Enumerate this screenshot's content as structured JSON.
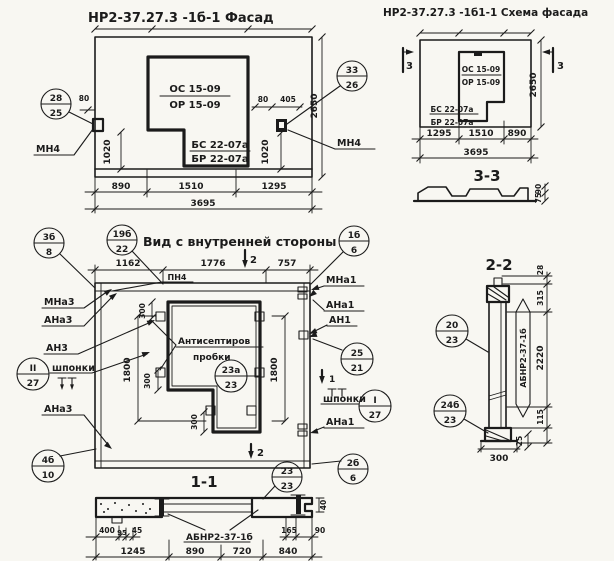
{
  "sheet": {
    "bg": "#f8f7f2",
    "ink": "#1b1b1b"
  },
  "facade": {
    "title": "НР2-37.27.3 -1б-1 Фасад",
    "window_mark_top": "ОС 15-09",
    "window_mark_bottom": "ОР 15-09",
    "sill_mark_top": "БС 22-07а",
    "sill_mark_bottom": "БР 22-07а",
    "anchor_left": "МН4",
    "anchor_right": "МН4",
    "callout_left_top": "28",
    "callout_left_bottom": "25",
    "callout_right_top": "33",
    "callout_right_bottom": "26",
    "dim_offset_left": "80",
    "dim_left_height": "1020",
    "dim_offset_right": "80",
    "dim_offset_right2": "405",
    "dim_right_height": "1020",
    "dim_height_total": "2650",
    "dim_w1": "890",
    "dim_w2": "1510",
    "dim_w3": "1295",
    "dim_w_total": "3695"
  },
  "schema": {
    "title": "НР2-37.27.3 -1б1-1 Схема фасада",
    "window_mark_top": "ОС 15-09",
    "window_mark_bottom": "ОР 15-09",
    "sill_mark_top": "БС 22-07а",
    "sill_mark_bottom": "БР 22-07а",
    "cut_left": "3",
    "cut_right": "3",
    "dim_height_total": "2650",
    "dim_w1": "1295",
    "dim_w2": "1510",
    "dim_w3": "890",
    "dim_w_total": "3695",
    "section_title": "3-3",
    "profile_dim_top": "90",
    "profile_dim_bottom": "75"
  },
  "interior": {
    "title": "Вид с внутренней стороны",
    "callout_title_top": "19б",
    "callout_title_bottom": "22",
    "callout_tl_top": "3б",
    "callout_tl_bottom": "8",
    "callout_tr_top": "1б",
    "callout_tr_bottom": "6",
    "dim_w1": "1162",
    "dim_w2": "1776",
    "dim_w3": "757",
    "cut_top": "2",
    "cut_bottom": "2",
    "cut_right": "1",
    "strip_label": "ПН4",
    "label_mna3": "МНа3",
    "label_ana3": "АНа3",
    "label_an3": "АН3",
    "label_keys_left": "шпонки",
    "label_ana3_low": "АНа3",
    "callout_keys_left_top": "II",
    "callout_keys_left_bottom": "27",
    "callout_bl_top": "4б",
    "callout_bl_bottom": "10",
    "label_mna1": "МНа1",
    "label_ana1": "АНа1",
    "label_an1": "АН1",
    "label_keys_right": "шпонки",
    "label_ana1_low": "АНа1",
    "callout_mid_right_top": "25",
    "callout_mid_right_bottom": "21",
    "callout_keys_right_top": "I",
    "callout_keys_right_bottom": "27",
    "callout_br_top": "2б",
    "callout_br_bottom": "6",
    "note_line1": "Антисептиров",
    "note_line2": "пробки",
    "callout_plugs_top": "23а",
    "callout_plugs_bottom": "23",
    "dim_300_a": "300",
    "dim_300_b": "300",
    "dim_300_c": "300",
    "dim_1800_left": "1800",
    "dim_1800_right": "1800"
  },
  "section11": {
    "title": "1-1",
    "callout_top": "23",
    "callout_bottom": "23",
    "label": "АБНР2-37-1б",
    "d400": "400",
    "d95": "95",
    "d45": "45",
    "d165": "165",
    "d90": "90",
    "d40": "40",
    "d1245": "1245",
    "d890": "890",
    "d720": "720",
    "d840": "840"
  },
  "section22": {
    "title": "2-2",
    "label": "АБНР2-37-1б",
    "callout_a_top": "20",
    "callout_a_bottom": "23",
    "callout_b_top": "24б",
    "callout_b_bottom": "23",
    "d28": "28",
    "d315": "315",
    "d2220": "2220",
    "d115": "115",
    "d25": "25",
    "d300": "300"
  }
}
